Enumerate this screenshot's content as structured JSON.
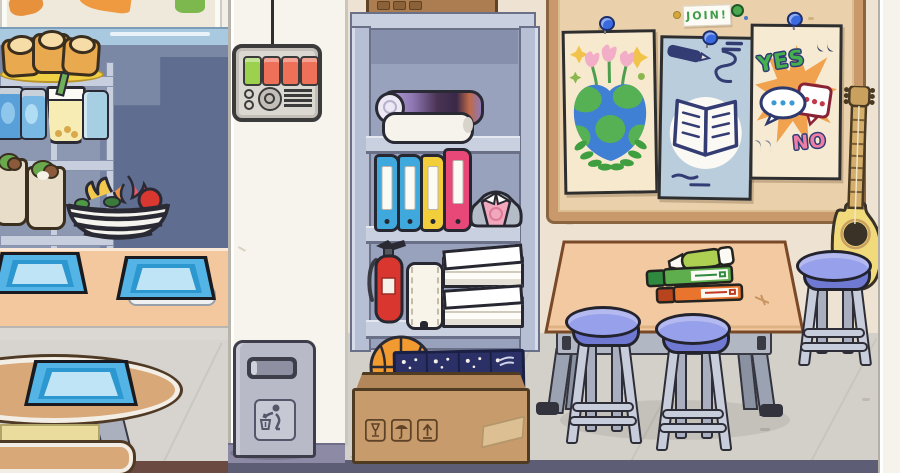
{
  "scene": {
    "title": "school-interior-scene",
    "style": "toca-life-cartoon"
  },
  "cafeteria": {
    "shelf_items": [
      "bread-loaves-plate",
      "soda-cans",
      "bubble-tea",
      "juice-jar",
      "veggie-wraps"
    ],
    "fruit_basket": [
      "bananas",
      "dragon-fruit",
      "apple",
      "greens"
    ],
    "tray_count": 3,
    "furniture": [
      "display-shelf",
      "serving-counter",
      "round-table",
      "bench"
    ]
  },
  "hallway": {
    "control_panel": {
      "buttons": [
        {
          "name": "green-button",
          "color": "#9cd14e"
        },
        {
          "name": "red-button-1",
          "color": "#ee7059"
        },
        {
          "name": "red-button-2",
          "color": "#ee7059"
        },
        {
          "name": "red-button-3",
          "color": "#ee7059"
        }
      ],
      "knob": "dial-knob",
      "speaker_lines": 4
    },
    "trash_can": {
      "sign_icon": "litter-disposal-icon"
    }
  },
  "storage": {
    "cabinet_shelves": {
      "top": [
        "rolled-poster-purple",
        "rolled-paper-white"
      ],
      "middle": [
        "binder-blue",
        "binder-blue",
        "binder-yellow",
        "binder-pink",
        "folded-uniform-shirt"
      ],
      "bottom": [
        "fire-extinguisher",
        "paper-towel-roll",
        "paper-stack",
        "paper-stack"
      ]
    },
    "floor_box": [
      "basketball",
      "blue-notebooks"
    ],
    "box_icons": [
      "fragile-glass-icon",
      "keep-dry-umbrella-icon",
      "this-side-up-icon"
    ]
  },
  "classroom": {
    "bulletin_board": {
      "join_sign": "JOIN!",
      "posters": [
        "earth-flowers-poster",
        "open-book-poster",
        "yes-no-poster"
      ],
      "yes_label": "YES",
      "no_label": "NO",
      "pin_color": "#3a6ae0"
    },
    "table_items": [
      "green-pen",
      "green-marker",
      "orange-marker"
    ],
    "furniture": [
      "activity-table",
      "stool",
      "stool",
      "stool",
      "acoustic-guitar"
    ]
  },
  "colors": {
    "cafeteria_wall": "#7b88a5",
    "cafeteria_wall_shadow": "#5f6d90",
    "counter": "#f3c89e",
    "tray_blue": "#54b4e6",
    "divider_wall": "#f7f4ed",
    "classroom_wall": "#eee3d3",
    "floor": "#d3d0c9",
    "cork_board": "#ead0ab",
    "board_frame": "#c9996b",
    "stool_blue": "#97a0ea",
    "table_top": "#f3c9a1",
    "cabinet": "#b6bfd4",
    "accent_yes_green": "#46b04e",
    "accent_no_pink": "#ee7ea6"
  }
}
